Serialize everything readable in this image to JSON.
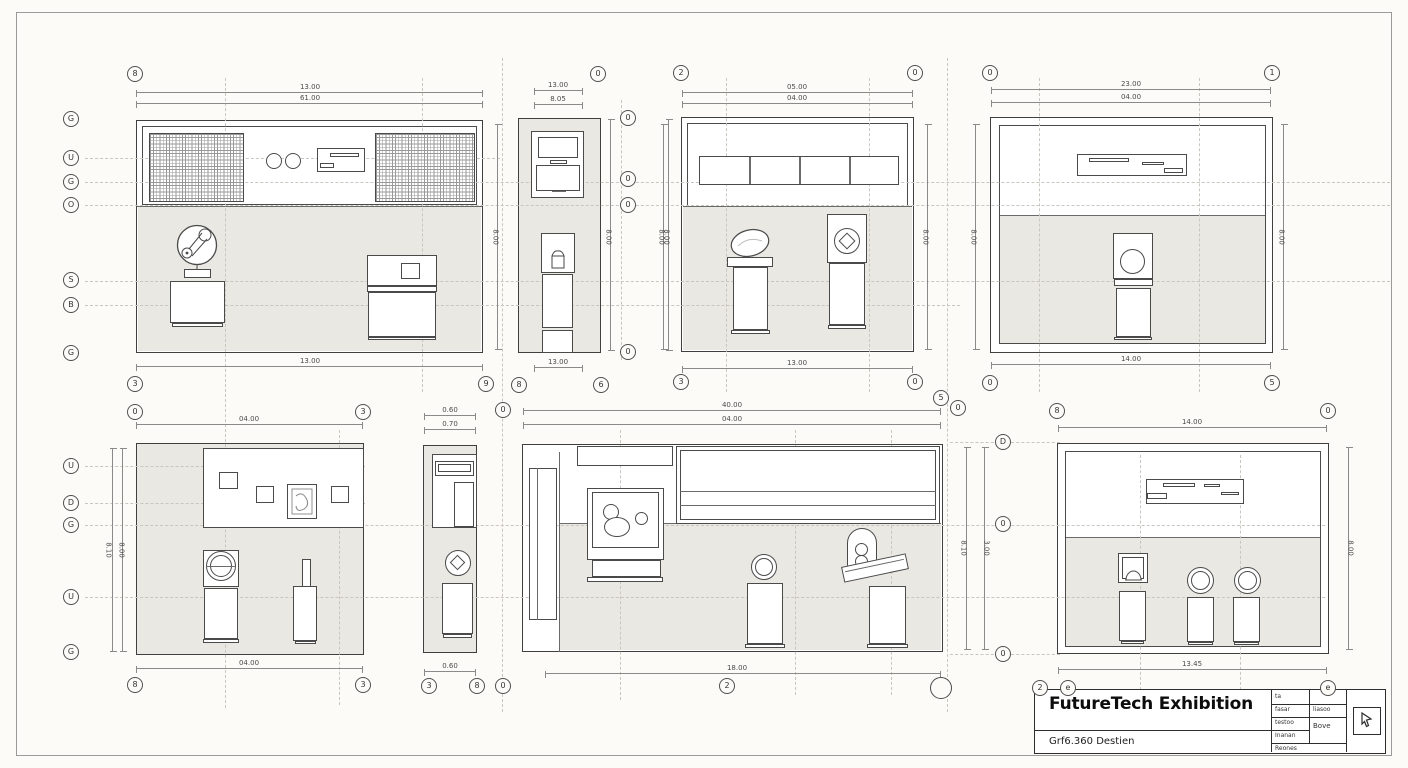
{
  "title_block": {
    "title": "FutureTech Exhibition",
    "subtitle": "Grf6.360 Destien",
    "table": {
      "r1c1": "ta",
      "r2c1": "fasar",
      "r2c2": "liasoo",
      "r3c1": "testoo",
      "r3c2": "Bove",
      "r4c1": "Inanan",
      "r5c1": "Reones"
    },
    "stamp_icon": "cursor-icon"
  },
  "colors": {
    "paper": "#fcfbf8",
    "line": "#4a4a4a",
    "wall_fill": "#e9e8e3",
    "centerline": "#c9c6c0"
  },
  "bubbles": {
    "p1_top": "8",
    "p1_bl": "3",
    "p1_br": "9",
    "left_col": [
      "G",
      "U",
      "G",
      "O",
      "S",
      "B",
      "G"
    ],
    "p2_top": "0",
    "p2_bl": "8",
    "p2_br": "6",
    "mid_col": [
      "0",
      "0",
      "0",
      "0"
    ],
    "p3_tl": "2",
    "p3_tr": "0",
    "p3_bl": "3",
    "p3_br": "0",
    "p4_tl": "0",
    "p4_tr": "1",
    "p4_bl": "0",
    "p4_br": "5",
    "p5_tl": "0",
    "p5_tr": "3",
    "p5_left": [
      "U",
      "D",
      "G",
      "U",
      "G"
    ],
    "p5_bl": "8",
    "p5_br": "3",
    "p6_top": "0",
    "p6_bl": "3",
    "p6_br": "8",
    "p6_b0": "0",
    "p7_t1": "5",
    "p7_t2": "0",
    "p7_b": "2",
    "p8_tl": "8",
    "p8_tr": "0",
    "p8_left": [
      "D",
      "0",
      "0"
    ],
    "p8_b1": "2",
    "p8_b2": "e",
    "p8_br": "e"
  },
  "dims": {
    "p1_t1": "13.00",
    "p1_t2": "61.00",
    "p1_b": "13.00",
    "p1_r": "8.00",
    "p2_t1": "13.00",
    "p2_t2": "8.05",
    "p2_b": "13.00",
    "mc_l": "8.00",
    "mc_r": "8.00",
    "p3_t1": "05.00",
    "p3_t2": "04.00",
    "p3_b": "13.00",
    "p3_l": "8.00",
    "p3_r": "8.00",
    "p3_r2": "8.00",
    "p4_t1": "23.00",
    "p4_t2": "04.00",
    "p4_b": "14.00",
    "p4_r": "8.00",
    "p5_t": "04.00",
    "p5_b": "04.00",
    "p5_l1": "8.10",
    "p5_l2": "8.00",
    "p6_t1": "0.60",
    "p6_t2": "0.70",
    "p6_b": "0.60",
    "p7_t1": "40.00",
    "p7_t2": "04.00",
    "p7_b": "18.00",
    "p7_r1": "8.10",
    "p7_r2": "3.00",
    "p8_t": "14.00",
    "p8_b": "13.45",
    "p8_r": "8.00"
  }
}
